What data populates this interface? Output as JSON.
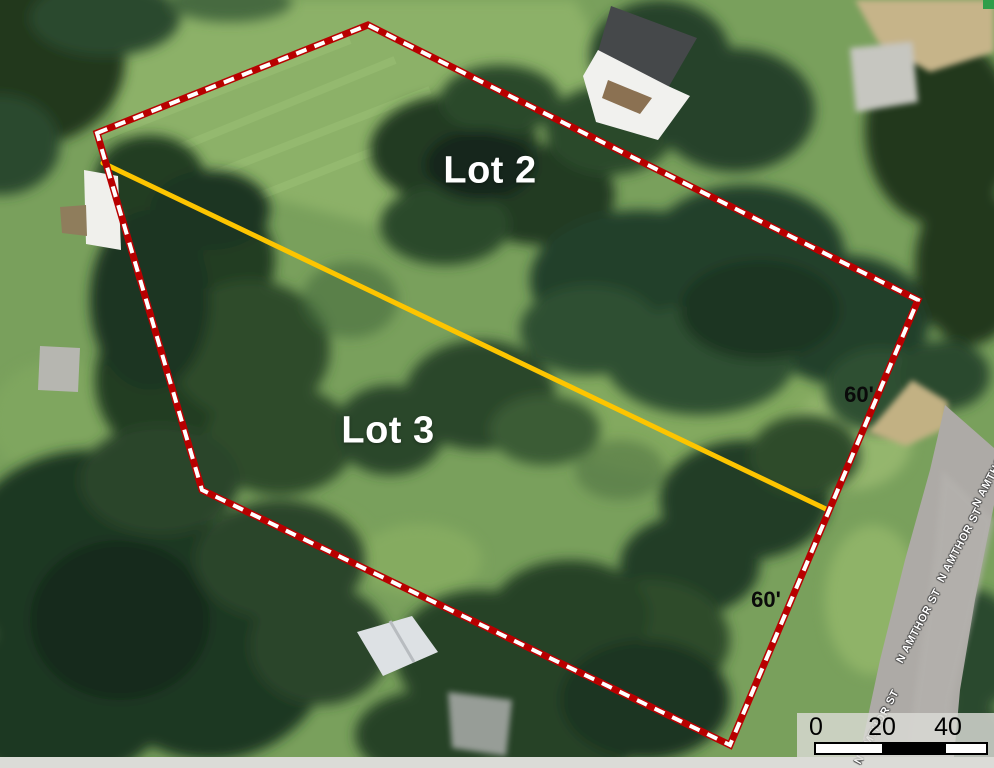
{
  "map": {
    "lots": [
      {
        "label": "Lot 2"
      },
      {
        "label": "Lot 3"
      }
    ],
    "dimensions": [
      {
        "text": "60'"
      },
      {
        "text": "60'"
      }
    ],
    "street_labels": [
      {
        "text": "N AMTHOR ST"
      },
      {
        "text": "N AMTHOR ST"
      },
      {
        "text": "N AMTHOR ST"
      },
      {
        "text": "N AMTHOR ST"
      }
    ],
    "scale_bar": {
      "ticks": [
        "0",
        "20",
        "40"
      ]
    },
    "colors": {
      "boundary_casing": "#b80000",
      "boundary_dash": "#ffffff",
      "lot_divider": "#fdc500",
      "lot_label": "#ffffff",
      "dimension_label": "#000000",
      "road": "#adaaa6"
    }
  }
}
